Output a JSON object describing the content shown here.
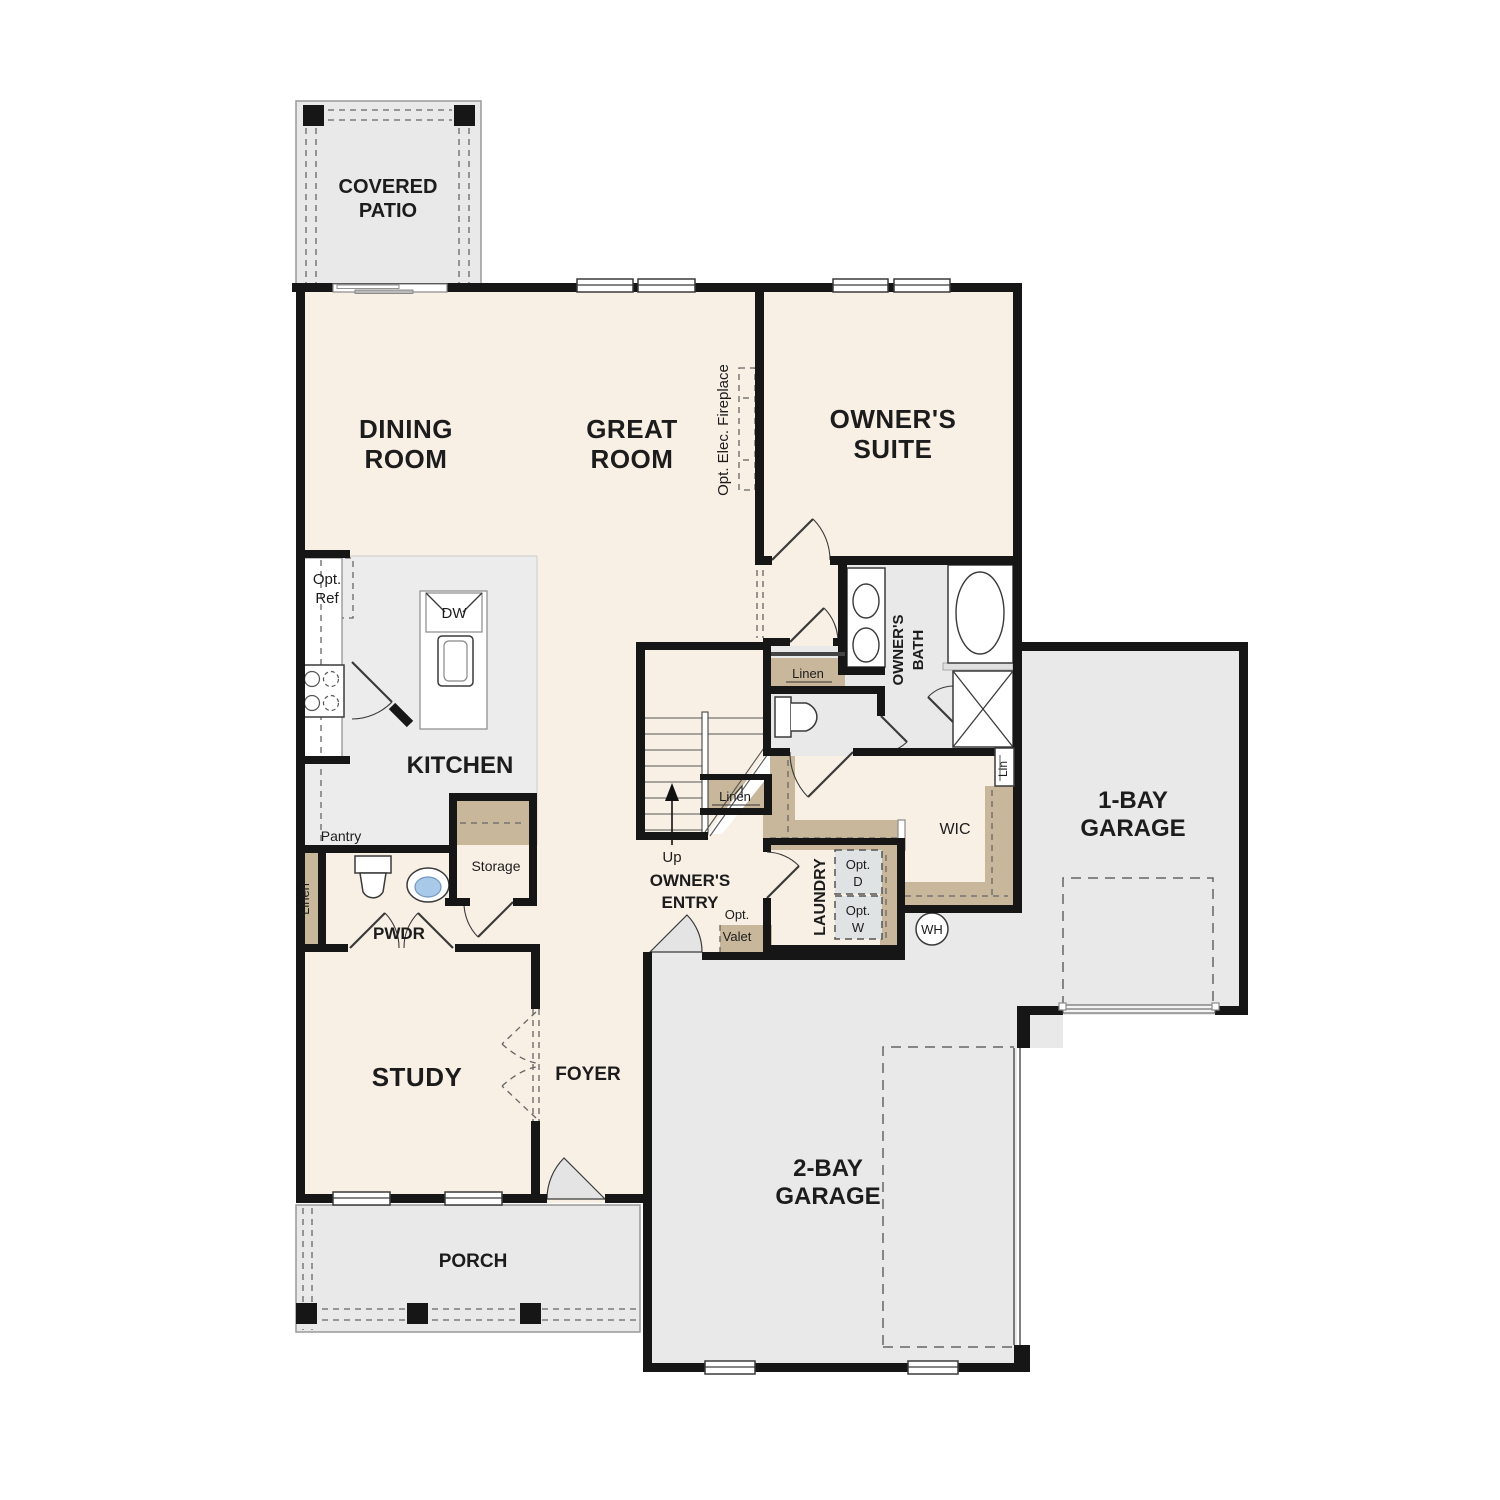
{
  "plan_type": "floor-plan",
  "colors": {
    "floor_beige": "#f8efe5",
    "floor_gray": "#e9e9e9",
    "closet_tan": "#c9b79b",
    "wall_black": "#161616",
    "sink_blue": "#a9c9e9",
    "opt_box_gray": "#dfe3e3"
  },
  "rooms": {
    "covered_patio": {
      "line1": "COVERED",
      "line2": "PATIO"
    },
    "dining_room": {
      "line1": "DINING",
      "line2": "ROOM"
    },
    "great_room": {
      "line1": "GREAT",
      "line2": "ROOM"
    },
    "owners_suite": {
      "line1": "OWNER'S",
      "line2": "SUITE"
    },
    "kitchen": {
      "label": "KITCHEN"
    },
    "owners_bath": {
      "line1": "OWNER'S",
      "line2": "BATH"
    },
    "wic": {
      "label": "WIC"
    },
    "laundry": {
      "label": "LAUNDRY"
    },
    "owners_entry": {
      "line1": "OWNER'S",
      "line2": "ENTRY"
    },
    "pwdr": {
      "label": "PWDR"
    },
    "study": {
      "label": "STUDY"
    },
    "foyer": {
      "label": "FOYER"
    },
    "porch": {
      "label": "PORCH"
    },
    "garage_1bay": {
      "line1": "1-BAY",
      "line2": "GARAGE"
    },
    "garage_2bay": {
      "line1": "2-BAY",
      "line2": "GARAGE"
    }
  },
  "features": {
    "opt_ref": {
      "line1": "Opt.",
      "line2": "Ref"
    },
    "opt_elec_fireplace": {
      "label": "Opt. Elec. Fireplace"
    },
    "dishwasher": {
      "label": "DW"
    },
    "pantry": {
      "label": "Pantry"
    },
    "storage": {
      "label": "Storage"
    },
    "linen_hall": {
      "label": "Linen"
    },
    "linen_stairs": {
      "label": "Linen"
    },
    "linen_pwdr": {
      "label": "Linen"
    },
    "lin_wic": {
      "label": "Lin"
    },
    "stairs_up": {
      "label": "Up"
    },
    "opt_dryer": {
      "line1": "Opt.",
      "line2": "D"
    },
    "opt_washer": {
      "line1": "Opt.",
      "line2": "W"
    },
    "opt_valet": {
      "line1": "Opt.",
      "line2": "Valet"
    },
    "water_heater": {
      "label": "WH"
    }
  }
}
